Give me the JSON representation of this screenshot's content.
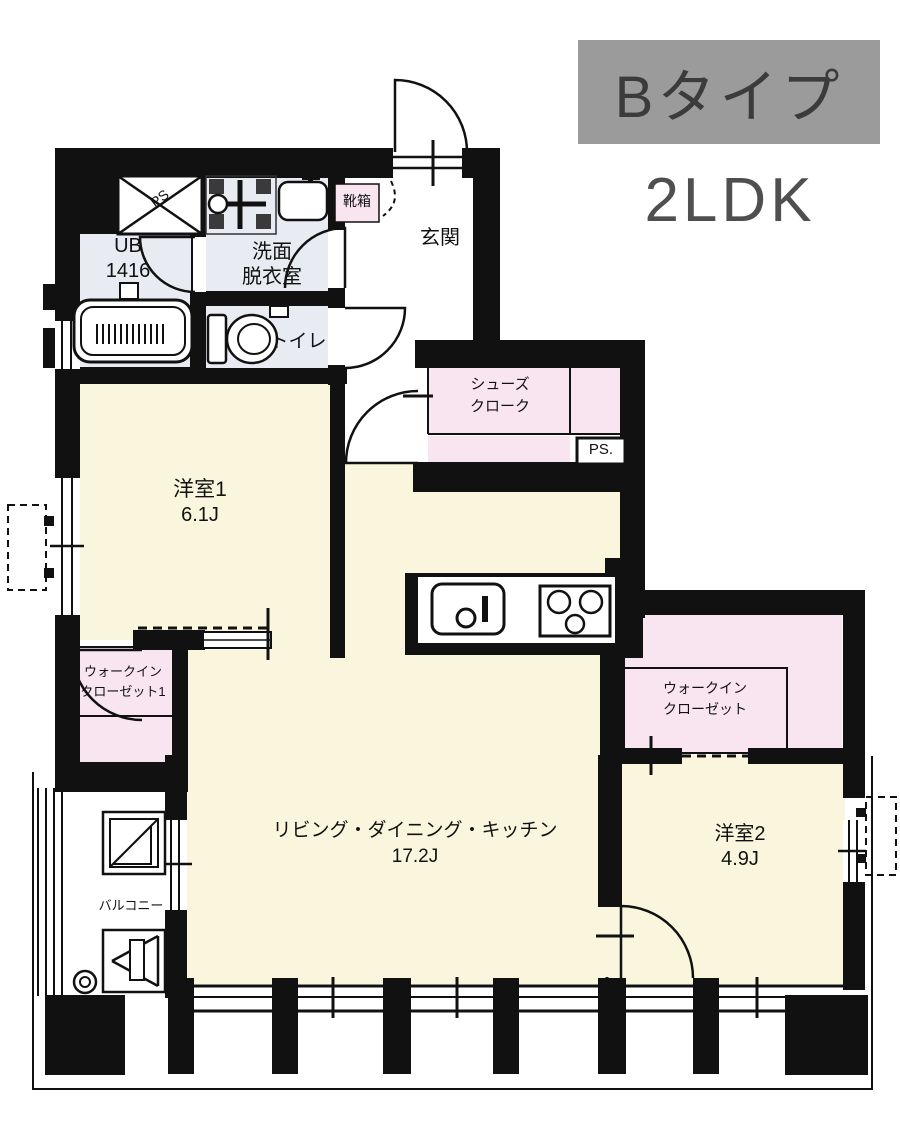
{
  "title": {
    "type": "Bタイプ",
    "plan": "2LDK"
  },
  "rooms": {
    "entry": {
      "label": "玄関"
    },
    "shoe_box": {
      "label": "靴箱"
    },
    "shoes_cloak": {
      "line1": "シューズ",
      "line2": "クローク"
    },
    "pipe_space_top": {
      "label": "PS"
    },
    "pipe_space_side": {
      "label": "PS."
    },
    "bath": {
      "line1": "UB",
      "line2": "1416"
    },
    "washroom": {
      "line1": "洗面",
      "line2": "脱衣室"
    },
    "toilet": {
      "label": "トイレ"
    },
    "bedroom1": {
      "name": "洋室1",
      "size": "6.1J"
    },
    "closet1": {
      "line1": "ウォークイン",
      "line2": "クローゼット1"
    },
    "ldk": {
      "name": "リビング・ダイニング・キッチン",
      "size": "17.2J"
    },
    "closet2": {
      "line1": "ウォークイン",
      "line2": "クローゼット"
    },
    "bedroom2": {
      "name": "洋室2",
      "size": "4.9J"
    },
    "balcony": {
      "label": "バルコニー"
    }
  },
  "colors": {
    "wall": "#111111",
    "room_cream": "#faf6dd",
    "room_pink": "#f8e5f0",
    "room_wet": "#e8ebf2",
    "title_bg": "#9b9b9b"
  }
}
